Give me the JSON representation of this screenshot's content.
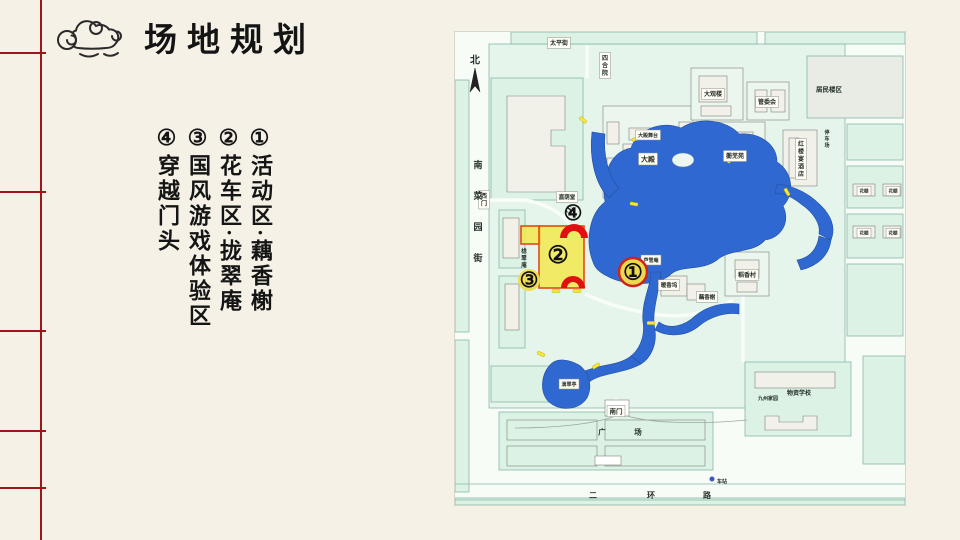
{
  "slide": {
    "title": "场地规划",
    "legend": [
      {
        "num": "①",
        "text": "活动区·藕香榭"
      },
      {
        "num": "②",
        "text": "花车区·拢翠庵"
      },
      {
        "num": "③",
        "text": "国风游戏体验区"
      },
      {
        "num": "④",
        "text": "穿越门头"
      }
    ]
  },
  "colors": {
    "paper": "#f6f1e7",
    "ruling_red": "#9e151c",
    "map_block": "#dcf2e5",
    "lake_blue": "#3068d2",
    "zone_yellow": "#f2e84c",
    "zone_border": "#e04b16",
    "arch_red": "#e01010",
    "marker_yellow": "#edd94f",
    "marker_ring_red": "#cf2218",
    "bridge_yellow": "#f7e838",
    "bus_dot_blue": "#3a57c8"
  },
  "map": {
    "labels": [
      {
        "t": "北",
        "x": 20,
        "y": 28,
        "s": 10
      },
      {
        "t": "太平街",
        "x": 104,
        "y": 11,
        "s": 6,
        "box": true
      },
      {
        "t": "四合院",
        "x": 150,
        "y": 26,
        "s": 6,
        "v": 1,
        "box": true
      },
      {
        "t": "居民楼区",
        "x": 374,
        "y": 57,
        "s": 6.5
      },
      {
        "t": "大观楼",
        "x": 258,
        "y": 62,
        "s": 6,
        "box": true
      },
      {
        "t": "管委会",
        "x": 312,
        "y": 70,
        "s": 6,
        "box": true
      },
      {
        "t": "蘅芜苑",
        "x": 280,
        "y": 124,
        "s": 6,
        "box": true
      },
      {
        "t": "红楼宴酒店",
        "x": 346,
        "y": 112,
        "s": 6,
        "v": 1,
        "box": true
      },
      {
        "t": "停车场",
        "x": 372,
        "y": 100,
        "s": 5,
        "v": 1
      },
      {
        "t": "大殿舞台",
        "x": 193,
        "y": 103,
        "s": 5,
        "box": true
      },
      {
        "t": "大殿",
        "x": 193,
        "y": 127,
        "s": 7,
        "box": true
      },
      {
        "t": "嘉荫堂",
        "x": 112,
        "y": 165,
        "s": 5.5,
        "box": true
      },
      {
        "t": "S",
        "x": 114,
        "y": 177,
        "s": 10,
        "italic": 1
      },
      {
        "t": "西门",
        "x": 29,
        "y": 164,
        "s": 6,
        "v": 1,
        "box": true
      },
      {
        "t": "南菜园街",
        "x": 23,
        "y": 133,
        "s": 9,
        "v": 1,
        "sp": 31
      },
      {
        "t": "栊翠庵",
        "x": 69,
        "y": 219,
        "s": 5.5,
        "v": 1
      },
      {
        "t": "芦雪庵",
        "x": 196,
        "y": 228,
        "s": 5,
        "box": true
      },
      {
        "t": "暖香坞",
        "x": 214,
        "y": 253,
        "s": 5.5,
        "box": true
      },
      {
        "t": "藕香榭",
        "x": 252,
        "y": 265,
        "s": 5.5,
        "box": true
      },
      {
        "t": "稻香村",
        "x": 292,
        "y": 243,
        "s": 6,
        "box": true
      },
      {
        "t": "滴翠亭",
        "x": 114,
        "y": 352,
        "s": 5,
        "box": true
      },
      {
        "t": "花棚",
        "x": 409,
        "y": 159,
        "s": 4.5,
        "box": true
      },
      {
        "t": "花棚",
        "x": 438,
        "y": 159,
        "s": 4.5,
        "box": true
      },
      {
        "t": "花棚",
        "x": 409,
        "y": 201,
        "s": 4.5,
        "box": true
      },
      {
        "t": "花棚",
        "x": 438,
        "y": 201,
        "s": 4.5,
        "box": true
      },
      {
        "t": "南门",
        "x": 161,
        "y": 379,
        "s": 6.5,
        "box": true
      },
      {
        "t": "广",
        "x": 147,
        "y": 400,
        "s": 7.5
      },
      {
        "t": "场",
        "x": 183,
        "y": 400,
        "s": 7.5
      },
      {
        "t": "九州家园",
        "x": 313,
        "y": 366,
        "s": 5
      },
      {
        "t": "物资学校",
        "x": 344,
        "y": 361,
        "s": 6
      },
      {
        "t": "二",
        "x": 138,
        "y": 463,
        "s": 8
      },
      {
        "t": "环",
        "x": 196,
        "y": 463,
        "s": 8
      },
      {
        "t": "路",
        "x": 252,
        "y": 463,
        "s": 8
      },
      {
        "t": "车站",
        "x": 267,
        "y": 449,
        "s": 5
      }
    ],
    "markers": [
      {
        "g": "①",
        "x": 178,
        "y": 240,
        "fs": 22,
        "circle": {
          "r": 14,
          "fill": "#edd94f",
          "stroke": "#cf2218",
          "sw": 2.5
        }
      },
      {
        "g": "②",
        "x": 103,
        "y": 223,
        "fs": 24
      },
      {
        "g": "③",
        "x": 74,
        "y": 248,
        "fs": 21,
        "circle": {
          "r": 11,
          "fill": "#f0dd52"
        }
      },
      {
        "g": "④",
        "x": 118,
        "y": 181,
        "fs": 21
      }
    ],
    "zones": [
      {
        "x": 66,
        "y": 194,
        "w": 19,
        "h": 18
      },
      {
        "x": 84,
        "y": 194,
        "w": 45,
        "h": 62
      }
    ],
    "arches": [
      {
        "cx": 119,
        "cy": 206,
        "ro": 14,
        "ri": 7
      },
      {
        "cx": 118,
        "cy": 256,
        "ro": 12,
        "ri": 6
      }
    ],
    "bridges": [
      {
        "x": 128,
        "y": 88,
        "r": 40
      },
      {
        "x": 181,
        "y": 107,
        "r": -15
      },
      {
        "x": 272,
        "y": 128,
        "r": 35
      },
      {
        "x": 179,
        "y": 172,
        "r": 10
      },
      {
        "x": 86,
        "y": 322,
        "r": 25
      },
      {
        "x": 141,
        "y": 334,
        "r": -30
      },
      {
        "x": 196,
        "y": 291,
        "r": 0
      },
      {
        "x": 101,
        "y": 259,
        "r": 0
      },
      {
        "x": 122,
        "y": 259,
        "r": 0
      },
      {
        "x": 332,
        "y": 160,
        "r": 60
      }
    ],
    "busstop": {
      "x": 257,
      "y": 447
    }
  }
}
